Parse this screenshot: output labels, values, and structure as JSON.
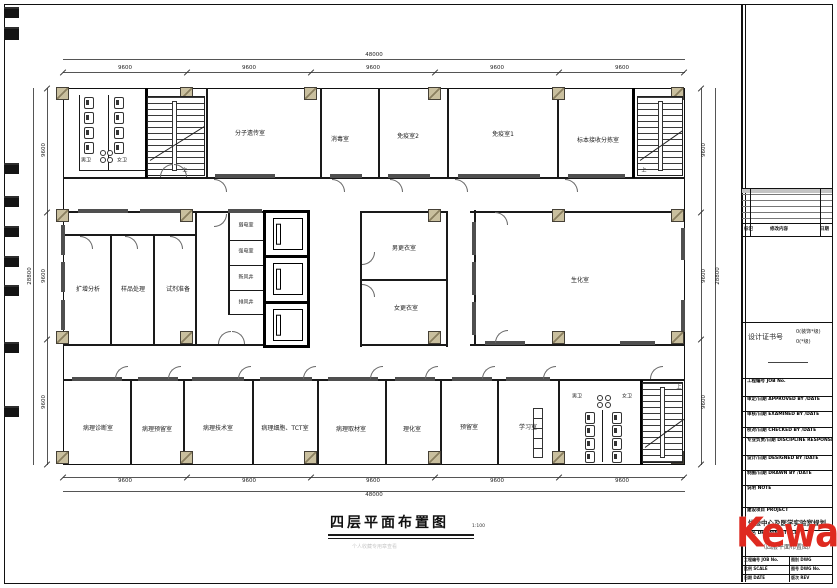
{
  "sheet": {
    "plan_title": "四层平面布置图",
    "plan_scale": "1:100",
    "footer_note": "个人收藏专用章查看"
  },
  "dims": {
    "overall_width": "48000",
    "overall_height": "28800",
    "top_segments": [
      "9600",
      "9600",
      "9600",
      "9600",
      "9600"
    ],
    "side_segments": [
      "9600",
      "9600",
      "9600"
    ]
  },
  "rooms": {
    "wc_m": "男卫",
    "wc_f": "女卫",
    "molecular": "分子遗传室",
    "disinfect": "消毒室",
    "immuno2": "免疫室2",
    "immuno1": "免疫室1",
    "specimen": "标本接收分拣室",
    "amplify": "扩增分析",
    "sample": "样品处理",
    "reagent": "试剂准备",
    "weak_power": "弱电室",
    "strong_power": "强电室",
    "fresh_air": "新风井",
    "exhaust": "排风井",
    "change_m": "男更衣室",
    "change_f": "女更衣室",
    "biochem": "生化室",
    "path_diag": "病理诊断室",
    "path_reserve": "病理预留室",
    "path_tech": "病理技术室",
    "path_cyto": "病理细胞、TCT室",
    "path_sample": "病理取材室",
    "physchem": "理化室",
    "reserve": "预留室",
    "study": "学习室",
    "up": "上"
  },
  "title_block": {
    "rev_cols": [
      "标记",
      "修改内容",
      "日期"
    ],
    "cert_label": "设计证书号",
    "cert_grade1": "0(装饰*级)",
    "cert_grade2": "0(*级)",
    "staff_rows": [
      {
        "label": "工程编号  JOB No."
      },
      {
        "label": "审定/日期  APPROVED BY /DATE"
      },
      {
        "label": "审核/日期  EXAMINED BY /DATE"
      },
      {
        "label": "校对/日期  CHECKED BY /DATE"
      },
      {
        "label": "专业负责/日期  DISCIPLINE RESPONSIBLE BY /DATE"
      },
      {
        "label": "设计/日期  DESIGNED BY /DATE"
      },
      {
        "label": "制图/日期  DRAWN BY /DATE"
      }
    ],
    "note_label": "说明  NOTE",
    "project_label": "建设项目  PROJECT",
    "project_name": "体检中心及医学实验室规划",
    "dwg_label": "图名  DRAWING TITLE",
    "dwg_name": "（四层平面布置图）",
    "grid_labels": [
      "工程编号 JOB No.",
      "图别 DWG",
      "比例 SCALE",
      "图号 DWG No.",
      "日期 DATE",
      "版次 REV"
    ]
  },
  "logo": {
    "red": "Kewa",
    "green": "tt"
  }
}
